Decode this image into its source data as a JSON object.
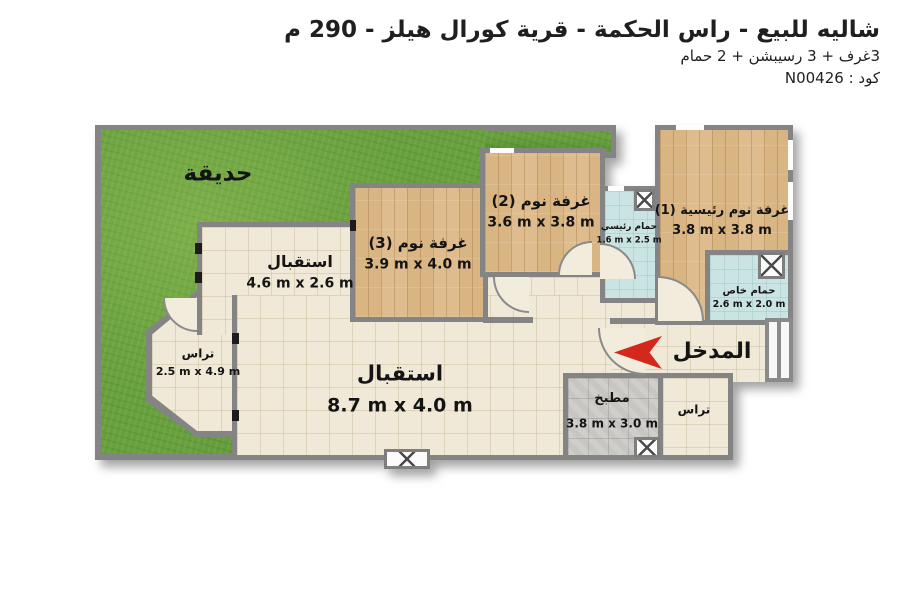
{
  "header": {
    "title": "شاليه للبيع - راس الحكمة - قرية كورال هيلز - 290 م",
    "subtitle": "3غرف + 3 رسيبشن + 2 حمام",
    "code": "كود : N00426"
  },
  "rooms": {
    "garden": {
      "name": "حديقة"
    },
    "reception_small": {
      "name": "استقبال",
      "dims": "4.6 m x 2.6 m"
    },
    "bedroom3": {
      "name": "غرفة نوم (3)",
      "dims": "3.9 m x 4.0 m"
    },
    "bedroom2": {
      "name": "غرفة نوم (2)",
      "dims": "3.6 m x 3.8 m"
    },
    "master_bedroom": {
      "name": "غرفة نوم رئيسية (1)",
      "dims": "3.8 m x 3.8 m"
    },
    "bathroom_main": {
      "name": "حمام رئيسي",
      "dims": "1.6 m x 2.5 m"
    },
    "bathroom_private": {
      "name": "حمام خاص",
      "dims": "2.6 m x 2.0 m"
    },
    "terrace_left": {
      "name": "تراس",
      "dims": "2.5 m x 4.9 m"
    },
    "reception_main": {
      "name": "استقبال",
      "dims": "8.7 m x 4.0 m"
    },
    "kitchen": {
      "name": "مطبخ",
      "dims": "3.8 m x 3.0 m"
    },
    "terrace_right": {
      "name": "تراس"
    },
    "entrance": {
      "name": "المدخل"
    }
  },
  "icons": {
    "entrance_arrow": "red left-pointing arrow",
    "window_x": "window / fixture X symbol",
    "door_arc": "door swing quarter arc",
    "stairs": "entry steps"
  },
  "colors": {
    "grass": "#67a03c",
    "wall": "#848484",
    "tile_floor": "#f0e9d7",
    "wood_floor": "#dfbc8d",
    "bath_floor": "#c9e4e3",
    "kitchen_floor": "#c7c6c3",
    "arrow_red": "#d3281c",
    "text": "#1f1f1f"
  }
}
